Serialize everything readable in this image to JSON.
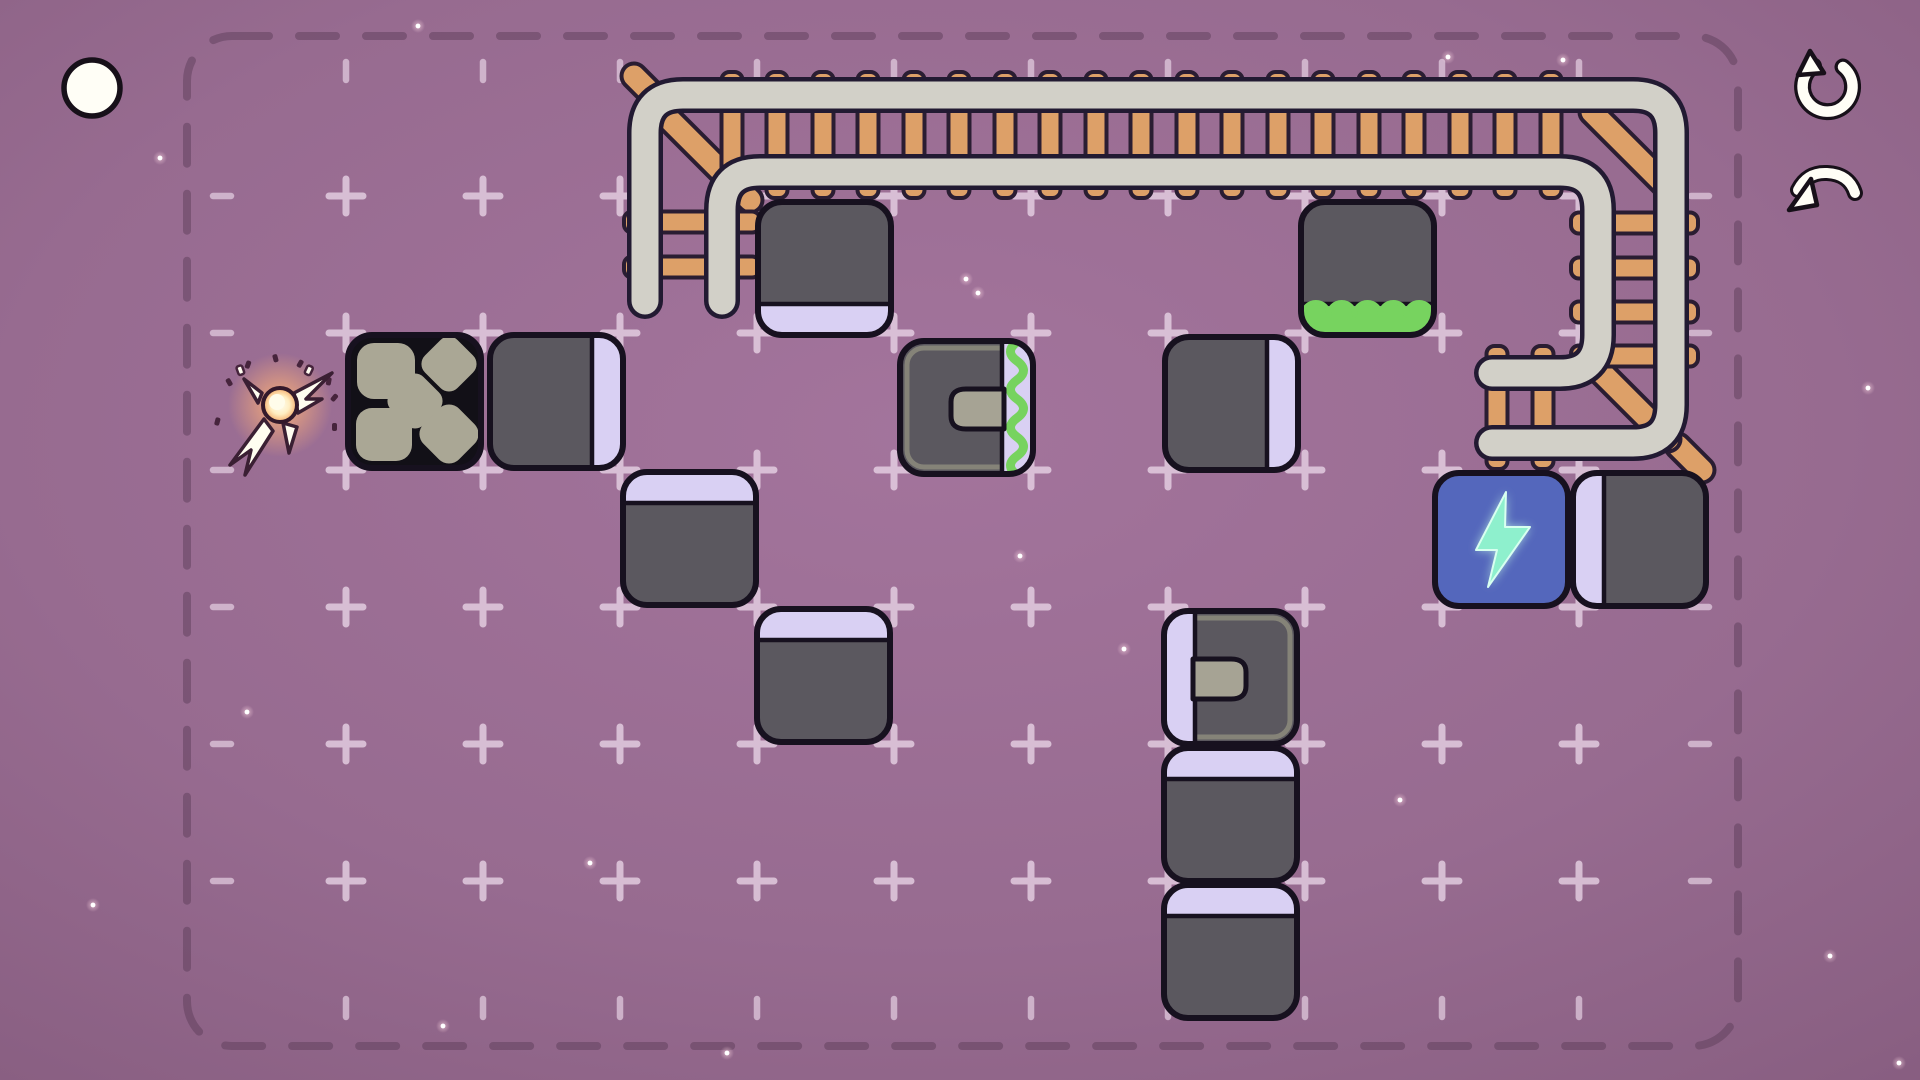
{
  "meta": {
    "game_view": "puzzle-level",
    "background_style": "purple starfield with vignette"
  },
  "colors": {
    "bg_center": "#a3749c",
    "bg_edge": "#73496c",
    "border_dash": "#5e3d59",
    "grid_mark": "#ecd9ea",
    "block_fill": "#5b585f",
    "block_outline": "#17111f",
    "stripe_lavender": "#d9d0f3",
    "sticky_green": "#77d35f",
    "stone_fill": "#aaa795",
    "stone_bg": "#121017",
    "rail_fill": "#d2d0c8",
    "rail_outline": "#221a32",
    "tie_fill": "#dda068",
    "tie_outline": "#2a1d32",
    "battery_fill": "#5467bc",
    "bolt_color": "#8ef0cd",
    "socket_notch": "#a6a394",
    "socket_rim": "#8a887b",
    "icon_fill": "#fffef6",
    "icon_outline": "#171019",
    "spark_glow": "#ffb277",
    "star": "#ffffff"
  },
  "hud": {
    "menu_circle": {
      "x": 92,
      "y": 88,
      "r": 28,
      "icon": "circle-menu-icon"
    },
    "restart": {
      "x": 1827,
      "y": 87,
      "icon": "restart-icon"
    },
    "undo": {
      "x": 1826,
      "y": 193,
      "icon": "undo-icon"
    }
  },
  "board": {
    "border": {
      "x": 187,
      "y": 36,
      "w": 1551,
      "h": 1010,
      "r": 45
    },
    "grid": {
      "origin_x": 209,
      "origin_y": 196,
      "cell": 137,
      "cross_cols": 10,
      "cross_rows": 6,
      "top_tick_y": 71,
      "bottom_tick_y": 1008,
      "left_tick_x": 222,
      "right_tick_x": 1700
    }
  },
  "blocks": [
    {
      "name": "block-stone",
      "col": 1,
      "row": 2,
      "type": "stone",
      "edge": null,
      "sticky": false,
      "offset": [
        0,
        0
      ]
    },
    {
      "name": "block-gray",
      "col": 2,
      "row": 2,
      "type": "plain",
      "edge": "right",
      "sticky": false,
      "offset": [
        5,
        0
      ]
    },
    {
      "name": "block-gray",
      "col": 4,
      "row": 1,
      "type": "plain",
      "edge": "bottom",
      "sticky": false,
      "offset": [
        -1,
        4
      ]
    },
    {
      "name": "block-socket-sticky",
      "col": 5,
      "row": 2,
      "type": "socket",
      "edge": "right",
      "sticky": true,
      "offset": [
        4,
        6
      ]
    },
    {
      "name": "block-gray",
      "col": 7,
      "row": 2,
      "type": "plain",
      "edge": "right",
      "sticky": false,
      "offset": [
        -5,
        2
      ]
    },
    {
      "name": "block-sticky-bottom",
      "col": 8,
      "row": 1,
      "type": "plain",
      "edge": "bottom",
      "sticky": true,
      "offset": [
        -6,
        4
      ]
    },
    {
      "name": "block-gray",
      "col": 3,
      "row": 3,
      "type": "plain",
      "edge": "top",
      "sticky": false,
      "offset": [
        1,
        0
      ]
    },
    {
      "name": "block-gray",
      "col": 4,
      "row": 4,
      "type": "plain",
      "edge": "top",
      "sticky": false,
      "offset": [
        -2,
        0
      ]
    },
    {
      "name": "block-battery",
      "col": 9,
      "row": 3,
      "type": "battery",
      "edge": null,
      "sticky": false,
      "offset": [
        -9,
        1
      ]
    },
    {
      "name": "block-gray",
      "col": 10,
      "row": 3,
      "type": "plain",
      "edge": "left",
      "sticky": false,
      "offset": [
        -8,
        1
      ]
    },
    {
      "name": "block-socket",
      "col": 7,
      "row": 4,
      "type": "socket",
      "edge": "left",
      "sticky": false,
      "offset": [
        -6,
        2
      ]
    },
    {
      "name": "block-gray",
      "col": 7,
      "row": 5,
      "type": "plain",
      "edge": "top",
      "sticky": false,
      "offset": [
        -6,
        2
      ]
    },
    {
      "name": "block-gray",
      "col": 7,
      "row": 6,
      "type": "plain",
      "edge": "top",
      "sticky": false,
      "offset": [
        -6,
        2
      ]
    }
  ],
  "track": {
    "rails": {
      "outer": "M645,301 L645,133 Q645,95 683,95 L1633,95 Q1671,95 1671,133 L1671,405 Q1671,443 1633,443 L1492,443",
      "inner": "M722,301 L722,210 Q722,172 760,172 L1560,172 Q1598,172 1598,210 L1598,335 Q1598,373 1560,373 L1492,373"
    },
    "tie_rows": [
      {
        "dir": "v",
        "xs": [
          732,
          777,
          823,
          868,
          914,
          959,
          1005,
          1050,
          1096,
          1141,
          1187,
          1232,
          1278,
          1323,
          1369,
          1414,
          1460,
          1505,
          1551
        ],
        "a": 72,
        "b": 198
      },
      {
        "dir": "h",
        "ys": [
          222,
          267
        ],
        "a": 624,
        "b": 760
      },
      {
        "dir": "h",
        "ys": [
          223,
          268,
          312,
          356
        ],
        "a": 1571,
        "b": 1698
      },
      {
        "dir": "v",
        "xs": [
          1497,
          1543
        ],
        "a": 346,
        "b": 469
      }
    ],
    "braces": [
      [
        668,
        118,
        750,
        200
      ],
      [
        1592,
        112,
        1670,
        190
      ],
      [
        1596,
        367,
        1668,
        439
      ]
    ],
    "stubs": [
      [
        634,
        76,
        658,
        100
      ],
      [
        1678,
        446,
        1702,
        470
      ]
    ]
  },
  "spark": {
    "x": 280,
    "y": 405
  },
  "stars": [
    [
      418,
      26
    ],
    [
      160,
      158
    ],
    [
      966,
      279
    ],
    [
      978,
      293
    ],
    [
      354,
      447
    ],
    [
      1020,
      556
    ],
    [
      590,
      863
    ],
    [
      1124,
      649
    ],
    [
      1400,
      800
    ],
    [
      1254,
      982
    ],
    [
      727,
      1053
    ],
    [
      1830,
      956
    ],
    [
      1899,
      1063
    ],
    [
      1543,
      187
    ],
    [
      1868,
      388
    ],
    [
      443,
      1026
    ],
    [
      247,
      712
    ],
    [
      1448,
      57
    ],
    [
      1563,
      60
    ],
    [
      93,
      905
    ]
  ]
}
